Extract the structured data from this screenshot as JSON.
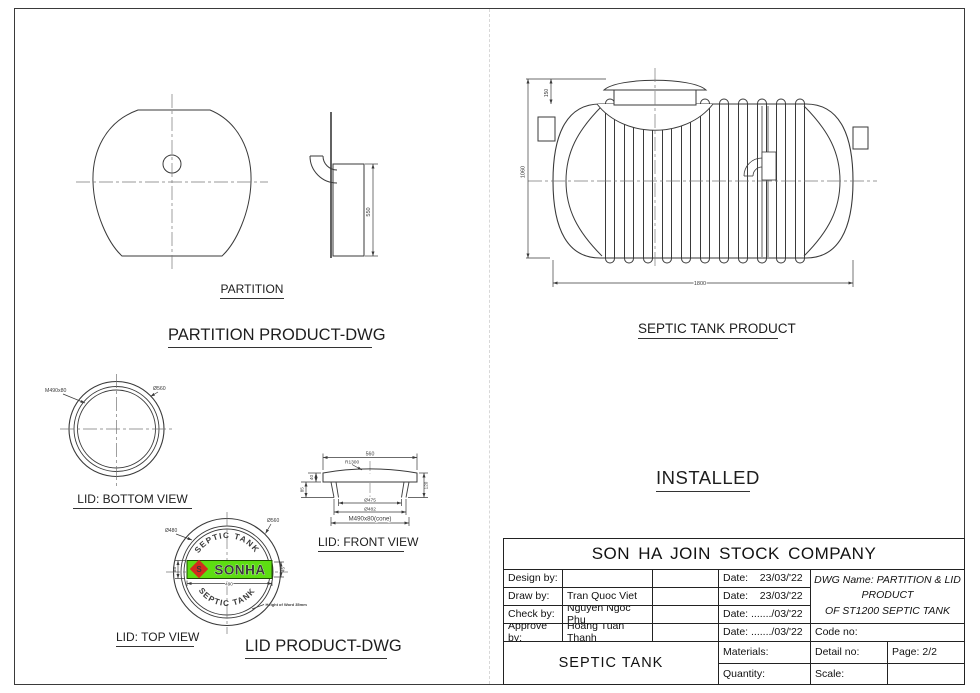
{
  "page": {
    "line_color": "#3a3a3a",
    "fold_line_color": "#d8d8d8"
  },
  "partition_view": {
    "caption": "PARTITION",
    "heading": "PARTITION PRODUCT-DWG",
    "dims": {
      "height": "550"
    }
  },
  "septic_tank_view": {
    "heading": "SEPTIC TANK PRODUCT",
    "dims": {
      "overall_height": "1060",
      "lid_height": "150",
      "length": "1800"
    }
  },
  "installed_label": "INSTALLED",
  "lid_bottom_view": {
    "caption": "LID: BOTTOM VIEW",
    "dims": {
      "thread": "M490x80",
      "outer_dia": "Ø560"
    }
  },
  "lid_front_view": {
    "caption": "LID: FRONT VIEW",
    "dims": {
      "width": "560",
      "radius": "R1300",
      "flange_h": "40",
      "neck_h": "85",
      "total_h": "120",
      "dia_475": "Ø475",
      "dia_482": "Ø482",
      "cone": "M490x80(cone)"
    }
  },
  "lid_top_view": {
    "caption": "LID: TOP VIEW",
    "heading": "LID PRODUCT-DWG",
    "dims": {
      "inner_dia": "Ø480",
      "outer_dia": "Ø560",
      "plate_h": "88",
      "letter_h": "45",
      "plate_w": "490"
    },
    "note": "Height of Word 35mm",
    "arc_text_top": "SEPTIC TANK",
    "arc_text_bottom": "SEPTIC TANK",
    "logo": {
      "text": "SONHA",
      "mark": "S",
      "bg": "#5ddd12",
      "red": "#d22b1e"
    }
  },
  "title_block": {
    "company": "SON HA JOIN STOCK COMPANY",
    "rows": [
      {
        "label": "Design by:",
        "name": "",
        "date": "Date:    23/03/'22"
      },
      {
        "label": "Draw by:",
        "name": "Tran Quoc Viet",
        "date": "Date:    23/03/'22"
      },
      {
        "label": "Check by:",
        "name": "Nguyen Ngoc Phu",
        "date": "Date: ......./03/'22"
      },
      {
        "label": "Approve by:",
        "name": "Hoang Tuan Thanh",
        "date": "Date: ......./03/'22"
      }
    ],
    "dwg_name": {
      "line1": "DWG Name: PARTITION & LID",
      "line2": "PRODUCT",
      "line3": "OF ST1200 SEPTIC TANK"
    },
    "code_no": "Code no:",
    "product": "SEPTIC TANK",
    "materials": "Materials:",
    "quantity": "Quantity:",
    "detail_no": "Detail no:",
    "scale": "Scale:",
    "page_no": "Page: 2/2"
  }
}
